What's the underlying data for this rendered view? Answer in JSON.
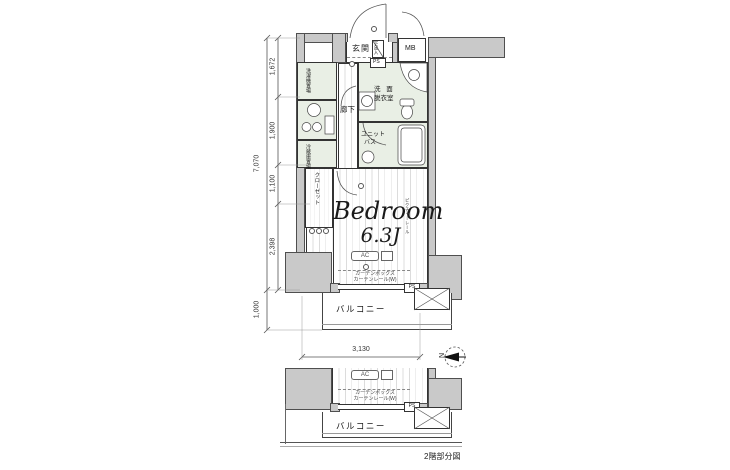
{
  "rooms": {
    "entrance": "玄関",
    "hallway": "廊下",
    "washroom": [
      "洗 面",
      "脱衣室"
    ],
    "unit_bath": [
      "ユニット",
      "バス"
    ],
    "bedroom": {
      "name": "Bedroom",
      "size": "6.3J"
    },
    "closet": "クローゼット",
    "balcony": "バルコニー",
    "washing_machine": "洗濯機置場",
    "refrigerator": "冷蔵庫置場",
    "shoe_box": "下足入"
  },
  "fixtures": {
    "mb": "MB",
    "ps": "PS",
    "ac": "AC",
    "picture_rail": "ピクチャーレール",
    "curtain_box": "カーテンボックス",
    "curtain_rail": "カーテンレール(W)"
  },
  "dimensions": {
    "total": "7,070",
    "segments": [
      "1,672",
      "1,900",
      "1,100",
      "2,398"
    ],
    "balcony_depth": "1,000",
    "width": "3,130"
  },
  "compass": {
    "north": "N"
  },
  "sub_diagram": {
    "caption": "2階部分図",
    "balcony": "バルコニー",
    "ac": "AC",
    "ps": "PS",
    "curtain_box": "カーテンボックス",
    "curtain_rail": "カーテンレール(W)"
  }
}
